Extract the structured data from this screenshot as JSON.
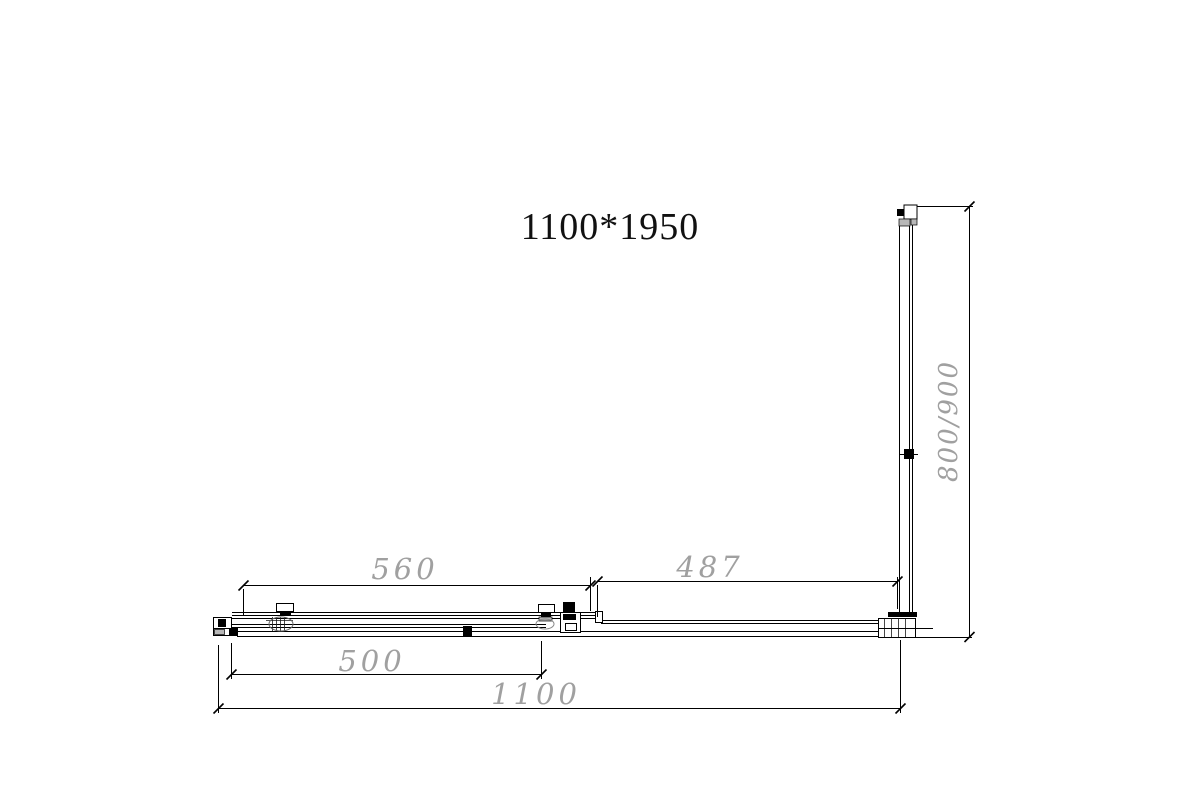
{
  "title": "1100*1950",
  "dimensions": {
    "door_top_width": "560",
    "fixed_panel_width": "487",
    "door_bottom_width": "500",
    "total_width": "1100",
    "side_depth": "800/900"
  },
  "colors": {
    "line": "#000000",
    "dimension_text": "#a0a0a0",
    "profile_fill": "#b8b8b8"
  }
}
